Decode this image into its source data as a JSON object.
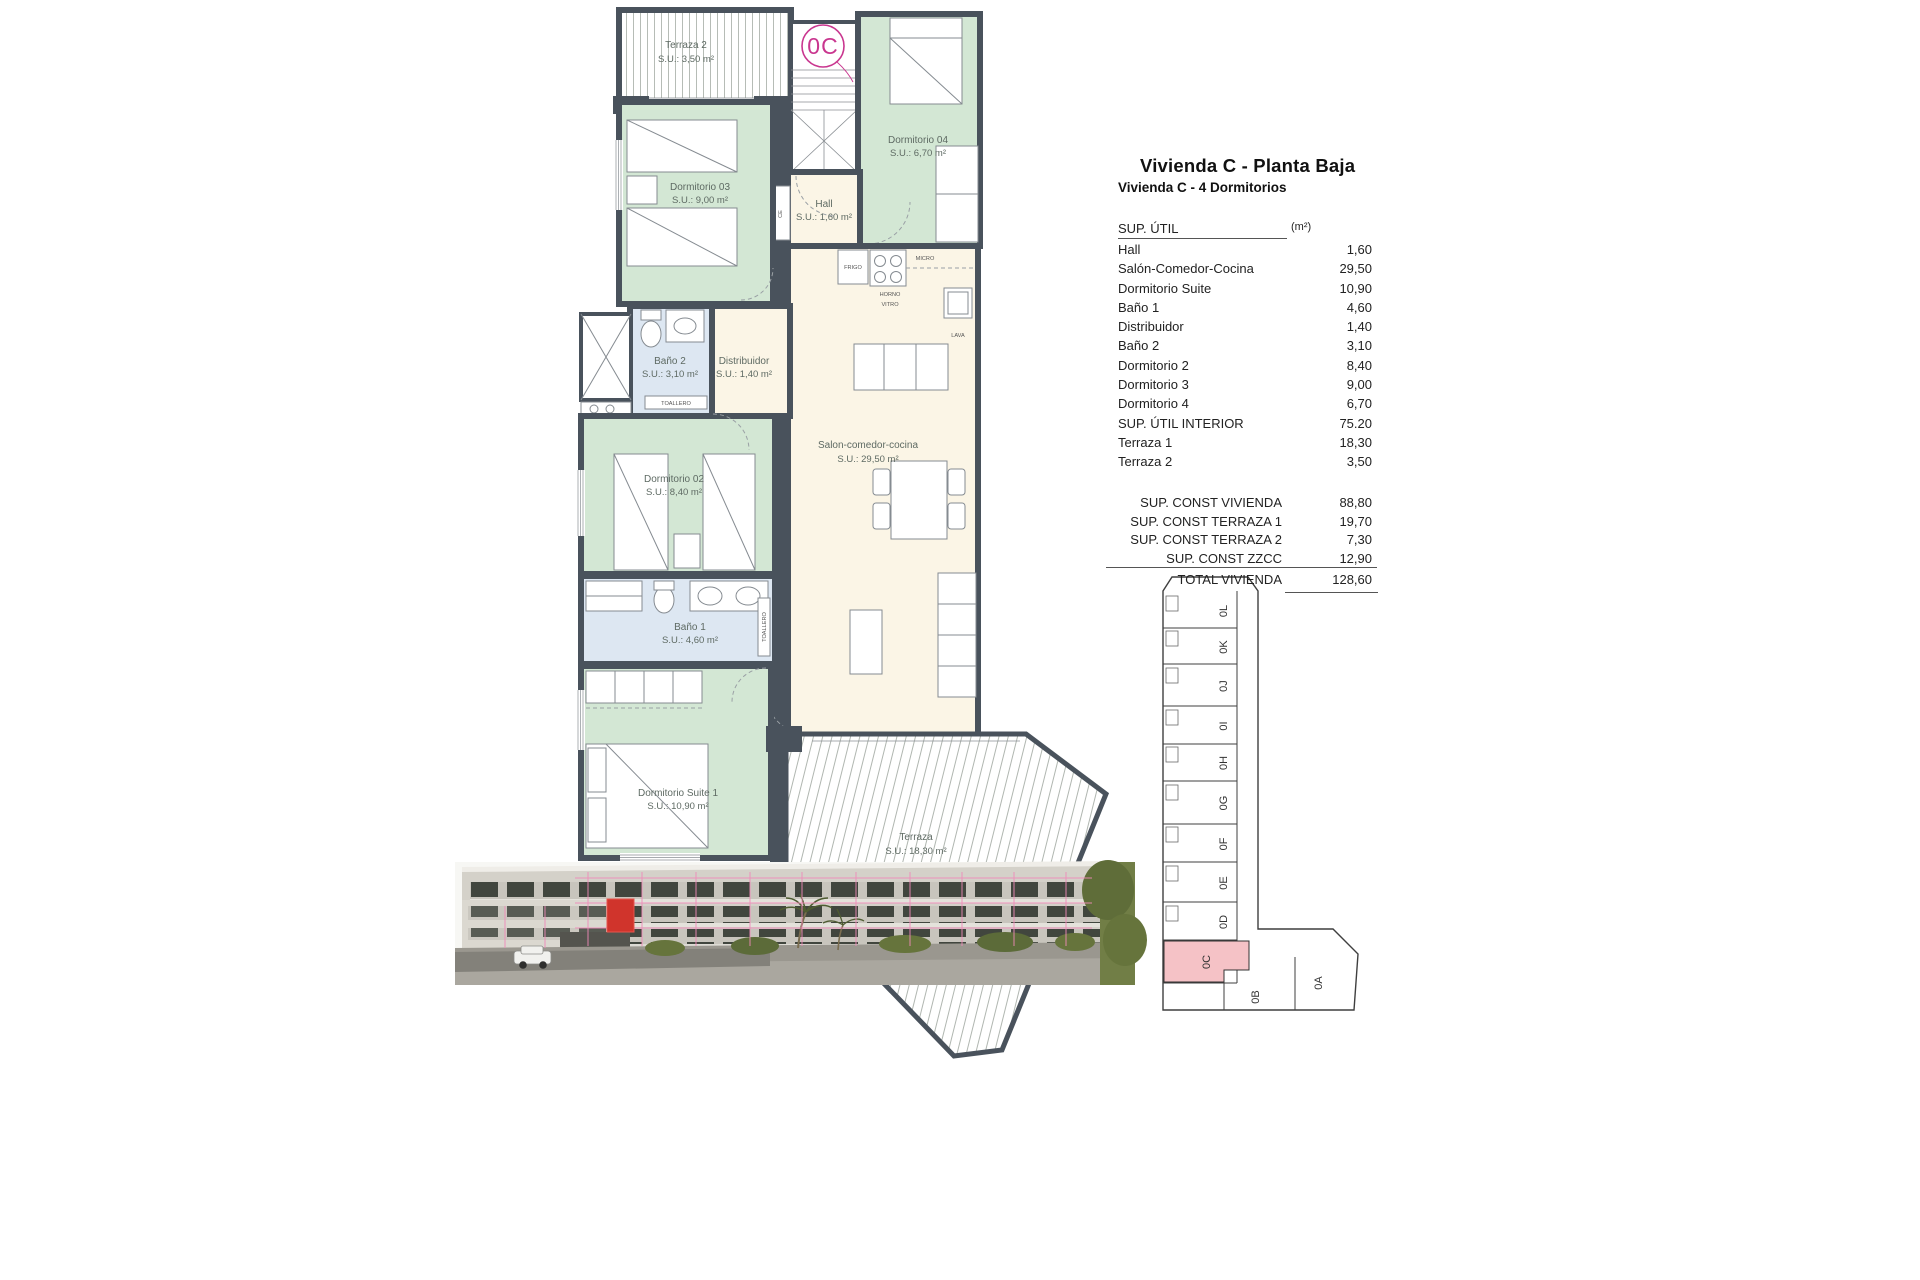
{
  "document": {
    "title": "Vivienda C - Planta Baja",
    "subtitle": "Vivienda C - 4 Dormitorios"
  },
  "area_table": {
    "header": {
      "label": "SUP. ÚTIL",
      "unit": "(m²)"
    },
    "rows": [
      {
        "label": "Hall",
        "value": "1,60"
      },
      {
        "label": "Salón-Comedor-Cocina",
        "value": "29,50"
      },
      {
        "label": "Dormitorio Suite",
        "value": "10,90"
      },
      {
        "label": "Baño 1",
        "value": "4,60"
      },
      {
        "label": "Distribuidor",
        "value": "1,40"
      },
      {
        "label": "Baño 2",
        "value": "3,10"
      },
      {
        "label": "Dormitorio 2",
        "value": "8,40"
      },
      {
        "label": "Dormitorio 3",
        "value": "9,00"
      },
      {
        "label": "Dormitorio 4",
        "value": "6,70"
      },
      {
        "label": "SUP. ÚTIL INTERIOR",
        "value": "75.20"
      },
      {
        "label": "Terraza 1",
        "value": "18,30"
      },
      {
        "label": "Terraza 2",
        "value": "3,50"
      }
    ],
    "summary_rows": [
      {
        "label": "SUP. CONST VIVIENDA",
        "value": "88,80"
      },
      {
        "label": "SUP. CONST TERRAZA 1",
        "value": "19,70"
      },
      {
        "label": "SUP. CONST TERRAZA 2",
        "value": "7,30"
      },
      {
        "label": "SUP. CONST ZZCC",
        "value": "12,90"
      },
      {
        "label": "TOTAL VIVIENDA",
        "value": "128,60"
      }
    ]
  },
  "floor_plan": {
    "unit_badge": "0C",
    "rooms": [
      {
        "name": "Terraza 2",
        "area": "S.U.: 3,50 m²"
      },
      {
        "name": "Dormitorio 04",
        "area": "S.U.: 6,70 m²"
      },
      {
        "name": "Dormitorio 03",
        "area": "S.U.: 9,00 m²"
      },
      {
        "name": "Hall",
        "area": "S.U.: 1,60 m²"
      },
      {
        "name": "Baño 2",
        "area": "S.U.: 3,10 m²"
      },
      {
        "name": "Distribuidor",
        "area": "S.U.: 1,40 m²"
      },
      {
        "name": "Dormitorio 02",
        "area": "S.U.: 8,40 m²"
      },
      {
        "name": "Salon-comedor-cocina",
        "area": "S.U.: 29,50 m²"
      },
      {
        "name": "Baño 1",
        "area": "S.U.: 4,60 m²"
      },
      {
        "name": "Dormitorio Suite 1",
        "area": "S.U.: 10,90 m²"
      },
      {
        "name": "Terraza",
        "area": "S.U.: 18,30 m²"
      }
    ],
    "fixtures": {
      "frigo": "FRIGO",
      "micro": "MICRO",
      "horno_line1": "HORNO",
      "horno_line2": "VITRO",
      "lava": "LAVA",
      "toallero": "TOALLERO",
      "ce": "CE",
      "acs": "ACS",
      "lavado": "LAVADO"
    }
  },
  "key_plan": {
    "units": [
      "0L",
      "0K",
      "0J",
      "0I",
      "0H",
      "0G",
      "0F",
      "0E",
      "0D",
      "0C",
      "0B",
      "0A"
    ],
    "highlighted_unit": "0C"
  },
  "colors": {
    "wall": "#49525c",
    "bedroom": "#d3e7d4",
    "living": "#fbf5e6",
    "bath": "#dde7f2",
    "highlight_pink": "#f5c2c6",
    "accent_magenta": "#c9368f"
  }
}
